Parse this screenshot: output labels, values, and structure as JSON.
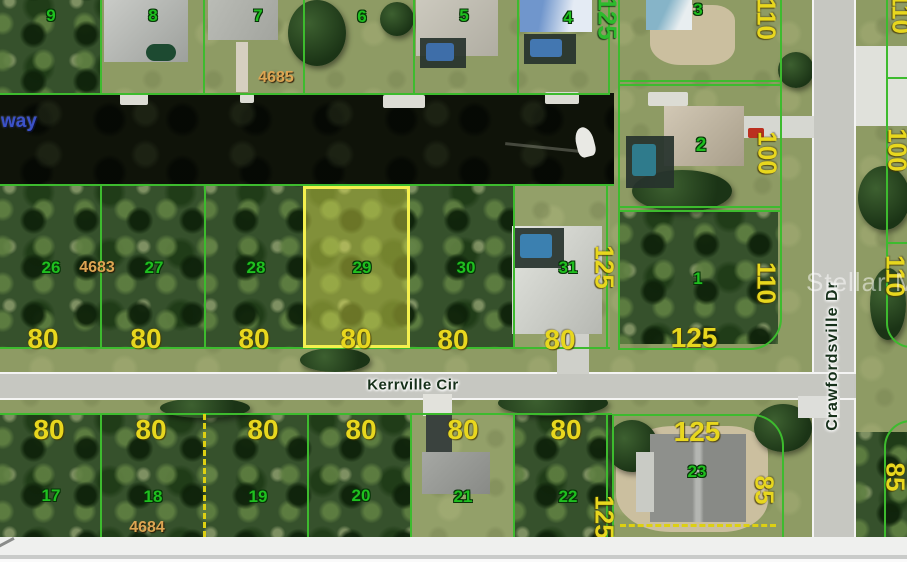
{
  "map": {
    "watermark": "Stellar MLS",
    "waterway_label": "way",
    "streets": {
      "horizontal": "Kerrville Cir",
      "vertical": "Crawfordsville Dr"
    },
    "block_numbers": {
      "top": "4685",
      "middle": "4683",
      "bottom": "4684"
    },
    "lots": {
      "top_row": [
        "9",
        "8",
        "7",
        "6",
        "5",
        "4",
        "3"
      ],
      "right_column": [
        "2",
        "1"
      ],
      "middle_row": [
        "26",
        "27",
        "28",
        "29",
        "30",
        "31"
      ],
      "bottom_row": [
        "17",
        "18",
        "19",
        "20",
        "21",
        "22",
        "23"
      ],
      "highlighted_lot": "29"
    },
    "frontages": {
      "middle_row": [
        "80",
        "80",
        "80",
        "80",
        "80",
        "80"
      ],
      "bottom_row": [
        "80",
        "80",
        "80",
        "80",
        "80",
        "80"
      ],
      "lot1": "125",
      "lot23": "125"
    },
    "depths": {
      "top_left": "125",
      "lot3": "110",
      "lot2": "100",
      "lot1": "110",
      "lot23": "85",
      "middle_left": "125",
      "bottom_left": "125",
      "right_edge_top": "110",
      "right_edge_upper": "100",
      "right_edge_middle": "110",
      "right_edge_bottom": "85"
    },
    "colors": {
      "boundary_line": "#3dbb2e",
      "highlight_fill": "#e9e74e",
      "highlight_border": "#f4f04e",
      "lot_number": "#1fbf1f",
      "dimension_label": "#e8d71e",
      "block_number": "#dca552",
      "street_label": "#16301a",
      "waterway_label": "#3b52c8"
    }
  }
}
